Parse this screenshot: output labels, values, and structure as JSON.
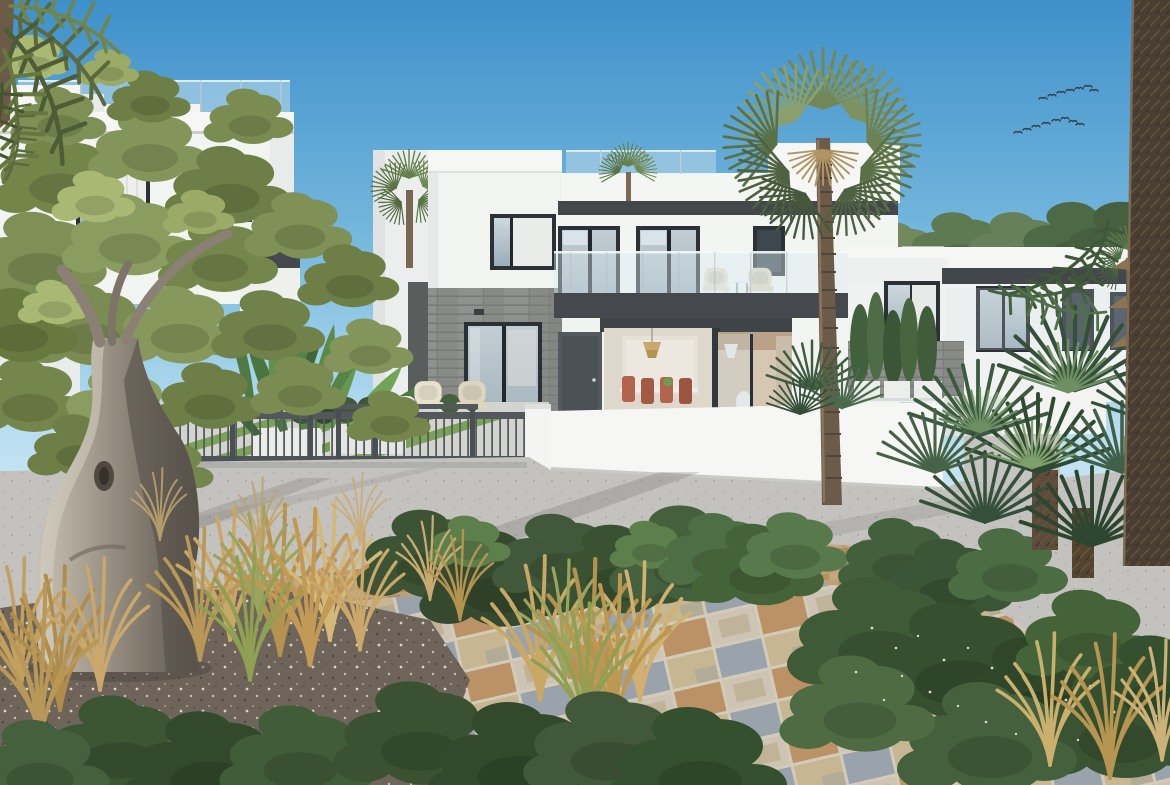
{
  "meta": {
    "title": "Architectural render: modern white two-storey villas with palm garden, gated driveway and stone tile path",
    "type": "photograph-render",
    "width_px": 1170,
    "height_px": 785
  },
  "palette": {
    "sky_top": "#3e90cb",
    "sky_mid": "#7ebfe3",
    "sky_horizon": "#d9edf7",
    "villa_white": "#f6f7f5",
    "villa_shaded": "#e9eceb",
    "roof_trim_dark": "#43474b",
    "balcony_slab": "#45494d",
    "window_frame": "#2c3135",
    "glass_blue": "#b9c8d2",
    "stone_grey": "#8f918e",
    "fence_grey": "#53585c",
    "door_grey": "#54595e",
    "lawn_green": "#7ba355",
    "hedge_green": "#6f9a4e",
    "road_grey": "#c3c2be",
    "brick_tan": "#c0a278",
    "tile_cream": "#c6b691",
    "tile_blue_grey": "#9aa3ab",
    "tile_brown": "#bb9265",
    "soil_brown": "#6e6459",
    "olive_green": "#75864c",
    "olive_trunk_grey": "#8a8174",
    "palm_green": "#718756",
    "fan_palm_dark": "#35503a",
    "palm_trunk_brown": "#6b5b48",
    "foreground_trunk_dark": "#4a3e32",
    "grass_straw": "#c9a866",
    "shrub_dark": "#3a5232",
    "rock_grey": "#8f897c",
    "wicker_cream": "#e6dfc9",
    "terracotta_chair": "#b2654c",
    "interior_beige": "#ded8cc",
    "pendant_rattan": "#c8a96c",
    "bird_dark": "#333a40",
    "flower_white": "#f2f4ee",
    "treeline_green": "#5d7a52"
  },
  "scene": {
    "sky": {
      "condition": "clear blue, brighter toward horizon",
      "birds_flock": {
        "bird_count": 15,
        "formation": "two loose diagonal lines, upper right sky"
      }
    },
    "buildings": {
      "left_villa": {
        "stories": 2,
        "style": "flat roof modern white villa",
        "features": [
          "glass roof-terrace balustrade",
          "stepped white parapets",
          "dark framed windows with white curtains",
          "dark inter-floor band"
        ]
      },
      "center_villa": {
        "stories": 2,
        "style": "flat roof modern white villa with grey stone-clad wing",
        "features": [
          "roof terrace with glass rail and small palm",
          "dark fascia band",
          "glass balcony with two wicker chairs and side table",
          "open sliding doors to dining room with rattan pendant and terracotta chairs",
          "kitchen opening with white cone pendant",
          "dark grey entrance door",
          "stone-clad wing with sliding glass door and two wicker patio chairs"
        ]
      },
      "right_villa": {
        "stories": 2,
        "style": "flat roof modern white villa",
        "features": [
          "dark fascia band",
          "dark framed windows",
          "stone-clad garden wall with white planter boxes and columnar shrubs",
          "green treeline behind"
        ]
      }
    },
    "landscape": {
      "olive_tree": "large gnarled-trunk olive tree at left with olive-green canopy",
      "windmill_palm": "tall fan-crown palm in front of centre villa balcony",
      "foreground_palm_trunk": "thick fibrous palm trunk along right image edge",
      "fan_palm_cluster": "dark green Mediterranean fan palms, lower right",
      "banana_plants": "banana / strelitzia leaves in white planters behind the gate fence",
      "front_yard": "striped lawn and pavement strips behind dark metal gate fence",
      "gate_fence": "dark grey metal fence with vertical bars between white posts",
      "boundary_wall": "long white rendered street wall in front of centre villa",
      "road": "light grey gravel road with long diagonal shadows",
      "brick_paving": "tan clay brick band between road and path",
      "tile_path": "large-format mixed cream/blue-grey/brown stone tile walkway in foreground",
      "planting_bed": "dark pebble mulch bed at lower left",
      "ornamental_grasses": "straw-coloured fountain grass clumps in foreground",
      "shrubs": "rounded dark green shrubs, some with tiny white flowers",
      "rock": "grey garden boulder right of centre",
      "bollard_light": "small white garden bollard near rock"
    }
  }
}
